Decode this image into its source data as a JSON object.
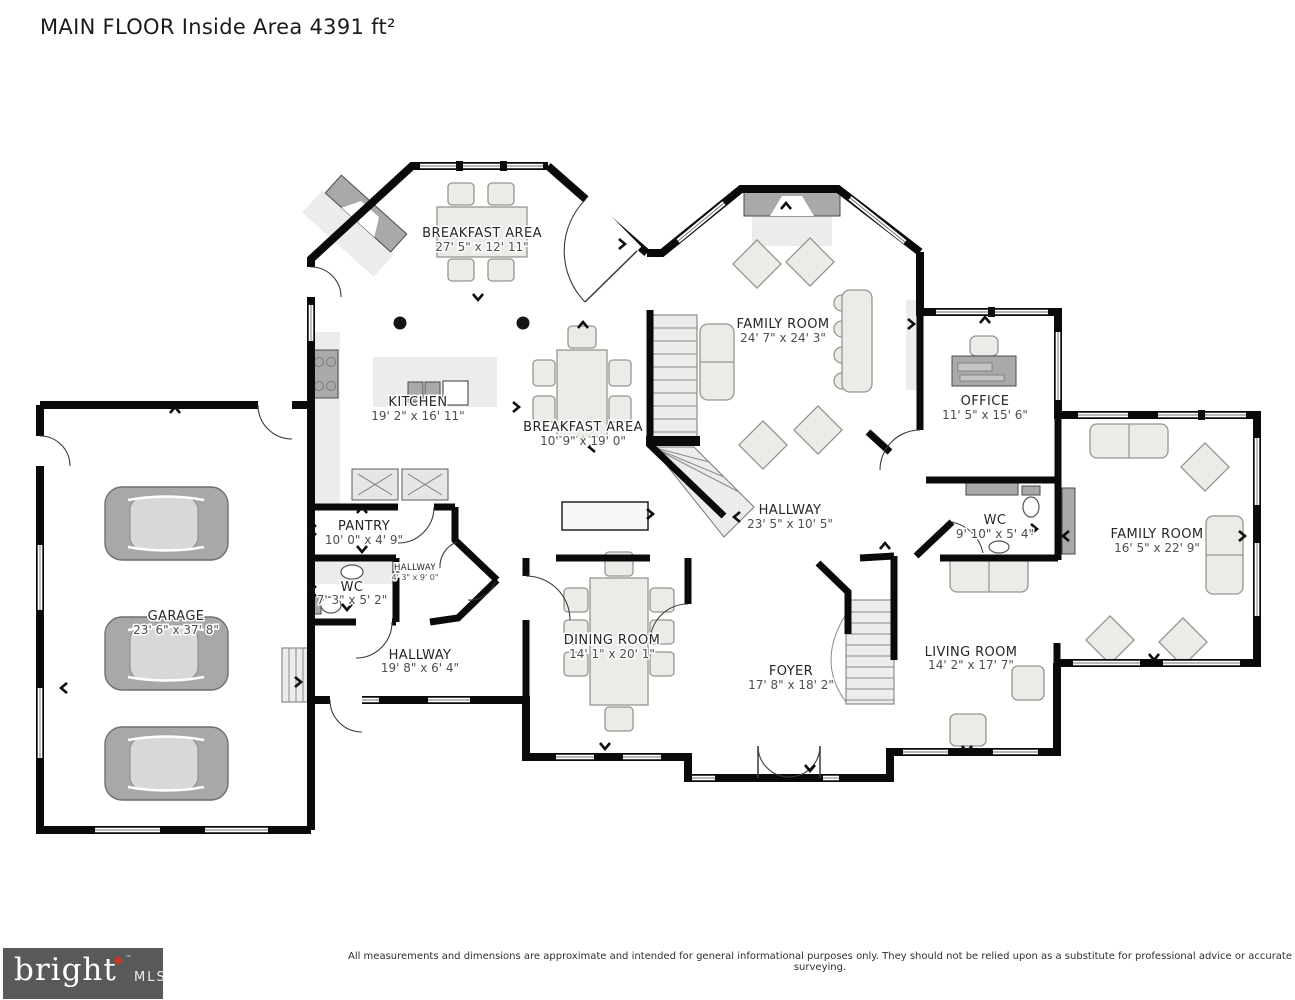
{
  "title": "MAIN FLOOR Inside Area 4391 ft²",
  "rooms": [
    {
      "name": "BREAKFAST AREA",
      "dims": "27' 5\" x 12' 11\""
    },
    {
      "name": "KITCHEN",
      "dims": "19' 2\" x 16' 11\""
    },
    {
      "name": "BREAKFAST AREA",
      "dims": "10' 9\" x 19' 0\""
    },
    {
      "name": "FAMILY ROOM",
      "dims": "24' 7\" x 24' 3\""
    },
    {
      "name": "OFFICE",
      "dims": "11' 5\" x 15' 6\""
    },
    {
      "name": "WC",
      "dims": "9' 10\" x 5' 4\""
    },
    {
      "name": "HALLWAY",
      "dims": "23' 5\" x 10' 5\""
    },
    {
      "name": "FAMILY ROOM",
      "dims": "16' 5\" x 22' 9\""
    },
    {
      "name": "PANTRY",
      "dims": "10' 0\" x 4' 9\""
    },
    {
      "name": "WC",
      "dims": "7' 3\" x 5' 2\""
    },
    {
      "name": "HALLWAY",
      "dims": "4' 3\" x 9' 0\""
    },
    {
      "name": "GARAGE",
      "dims": "23' 6\" x 37' 8\""
    },
    {
      "name": "HALLWAY",
      "dims": "19' 8\" x 6' 4\""
    },
    {
      "name": "DINING ROOM",
      "dims": "14' 1\" x 20' 1\""
    },
    {
      "name": "FOYER",
      "dims": "17' 8\" x 18' 2\""
    },
    {
      "name": "LIVING ROOM",
      "dims": "14' 2\" x 17' 7\""
    }
  ],
  "footer": {
    "brand": "bright",
    "brand_tm": "™",
    "brand_sub": "MLS",
    "disclaimer": "All measurements and dimensions are approximate and intended for general informational purposes only. They should not be relied upon as a substitute for professional advice or accurate surveying."
  },
  "colors": {
    "wall": "#0a0a0a",
    "furniture": "#ebebe8",
    "car": "#a8a8a8",
    "logo_bg": "#58595b",
    "logo_accent": "#c23b22"
  }
}
